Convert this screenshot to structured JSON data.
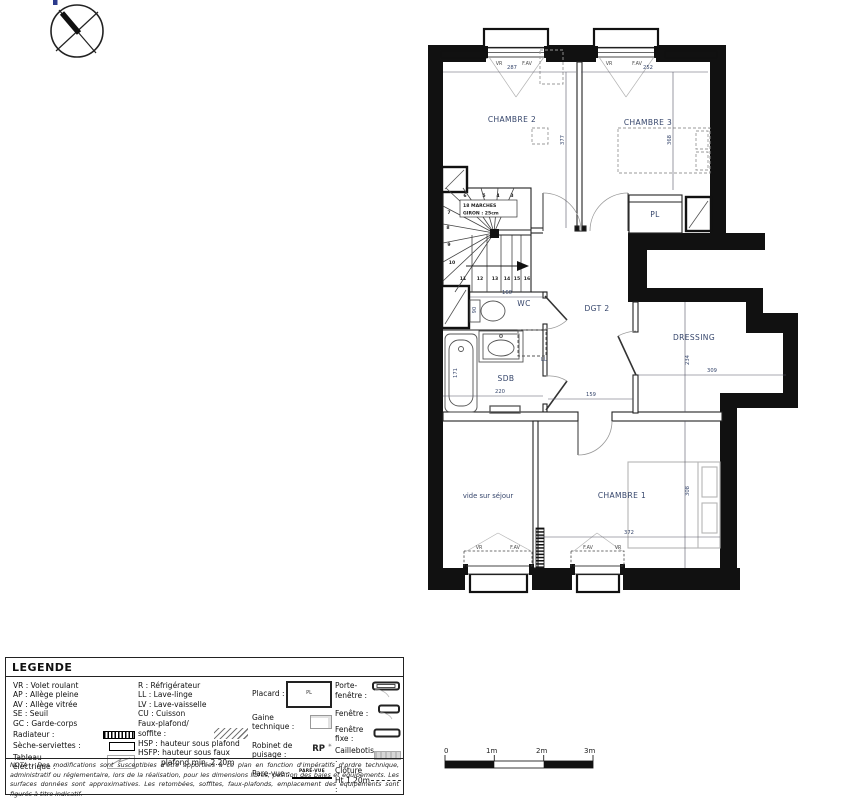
{
  "colors": {
    "wall": "#111111",
    "plan_annotation": "#35456b"
  },
  "plan": {
    "rooms": {
      "chambre2": "CHAMBRE 2",
      "chambre3": "CHAMBRE 3",
      "chambre1": "CHAMBRE 1",
      "pl": "PL",
      "dgt2": "DGT 2",
      "dressing": "DRESSING",
      "wc": "WC",
      "sdb": "SDB",
      "vide": "vide sur séjour"
    },
    "dims": {
      "w_ch2": "287",
      "w_ch3": "252",
      "h_ch2": "377",
      "h_ch3": "368",
      "wc_w": "160",
      "wc_d": "90",
      "sdb_w": "220",
      "sdb_d": "171",
      "dgt_w": "159",
      "dress_d": "234",
      "dress_w": "309",
      "ch1_w": "372",
      "ch1_d": "308"
    },
    "win": {
      "vr": "VR",
      "fav": "F.AV"
    },
    "ll": "LL",
    "stairs": {
      "line1": "18 MARCHES",
      "line2": "GIRON : 25cm",
      "steps": [
        "3",
        "4",
        "5",
        "6",
        "7",
        "8",
        "9",
        "10",
        "11",
        "12",
        "13",
        "14",
        "15",
        "16"
      ]
    }
  },
  "scalebar": {
    "t0": "0",
    "t1": "1m",
    "t2": "2m",
    "t3": "3m"
  },
  "legend": {
    "title": "LEGENDE",
    "left": [
      "VR : Volet roulant",
      "AP : Allège pleine",
      "AV : Allège vitrée",
      "SE : Seuil",
      "GC : Garde-corps"
    ],
    "radiateur": "Radiateur :",
    "seche": "Sèche-serviettes :",
    "tableau1": "Tableau",
    "tableau2": "électrique :",
    "mid": [
      "R : Réfrigérateur",
      "LL : Lave-linge",
      "LV : Lave-vaisselle",
      "CU : Cuisson"
    ],
    "faux1": "Faux-plafond/",
    "faux2": "soffite :",
    "hsp": "HSP : hauteur sous plafond",
    "hsfp1": "HSFP: hauteur sous faux",
    "hsfp2": "plafond min. 2.20m",
    "placard": "Placard :",
    "pl_abbr": "PL",
    "gaine1": "Gaine",
    "gaine2": "technique :",
    "robinet1": "Robinet de",
    "robinet2": "puisage :",
    "rp": "RP",
    "parevue": "Pare-vue :",
    "parevue_cap": "PARE-VUE",
    "porte_fenetre": "Porte-fenêtre :",
    "fenetre": "Fenêtre :",
    "fenetre_fixe": "Fenêtre fixe :",
    "caillebotis": "Caillebotis :",
    "cloture1": "Clôture",
    "cloture2": "Ht 1.20m :"
  },
  "nota": "NOTA : Des modifications sont susceptibles d'être apportées à ce plan en fonction d'impératifs d'ordre technique, administratif ou réglementaire, lors de la réalisation, pour les dimensions libres, position des baies et équipements. Les surfaces données sont approximatives. Les retombées, soffites, faux-plafonds, emplacement des équipements sont figurés à titre indicatif."
}
